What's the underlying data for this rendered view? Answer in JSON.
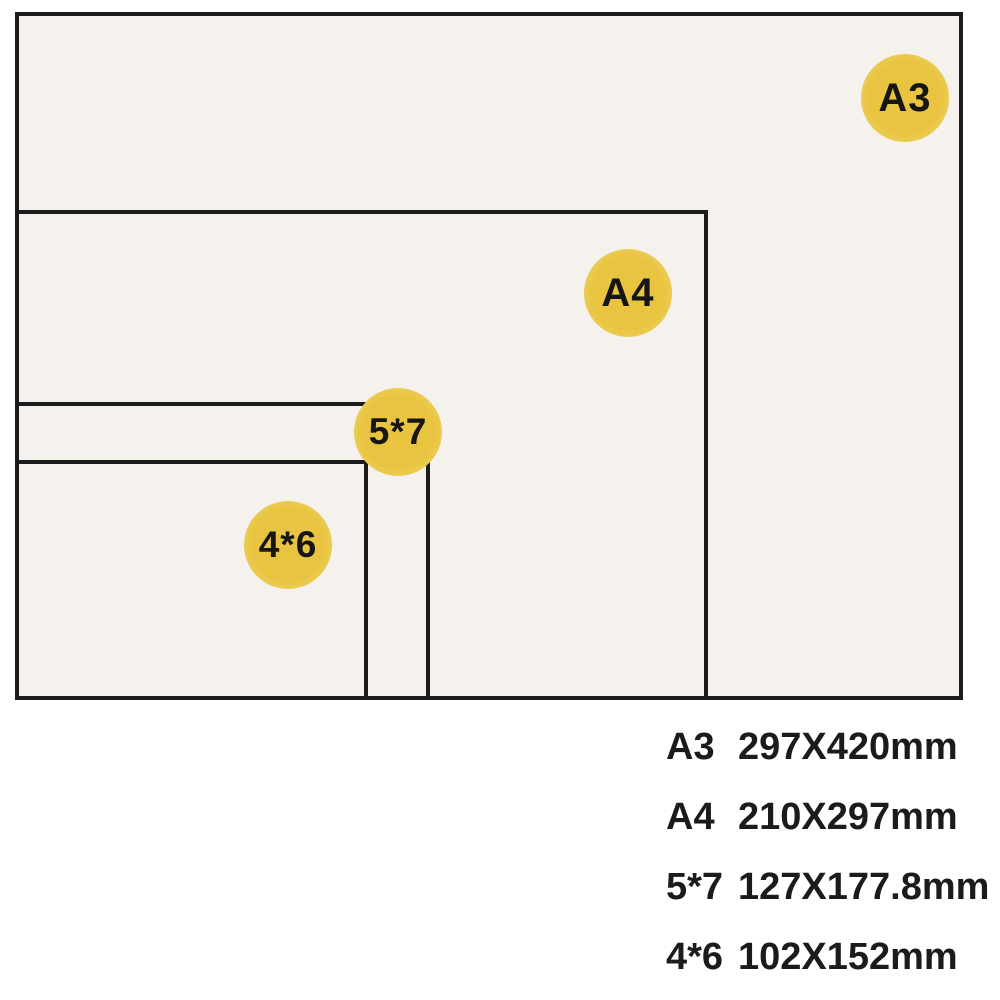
{
  "colors": {
    "background": "#ffffff",
    "paper_fill": "#f5f2ed",
    "outline": "#1c1c1c",
    "badge_yellow": "#e8c440",
    "badge_yellow_mid": "#edd162",
    "badge_yellow_light": "#f3e9b0",
    "badge_text": "#161616",
    "text": "#1b1b1b"
  },
  "diagram": {
    "sheets": [
      {
        "id": "a3",
        "badge": "A3"
      },
      {
        "id": "a4",
        "badge": "A4"
      },
      {
        "id": "5x7",
        "badge": "5*7"
      },
      {
        "id": "4x6",
        "badge": "4*6"
      }
    ]
  },
  "legend": {
    "items": [
      {
        "size": "A3",
        "dimensions": "297X420mm"
      },
      {
        "size": "A4",
        "dimensions": "210X297mm"
      },
      {
        "size": "5*7",
        "dimensions": "127X177.8mm"
      },
      {
        "size": "4*6",
        "dimensions": "102X152mm"
      }
    ]
  }
}
